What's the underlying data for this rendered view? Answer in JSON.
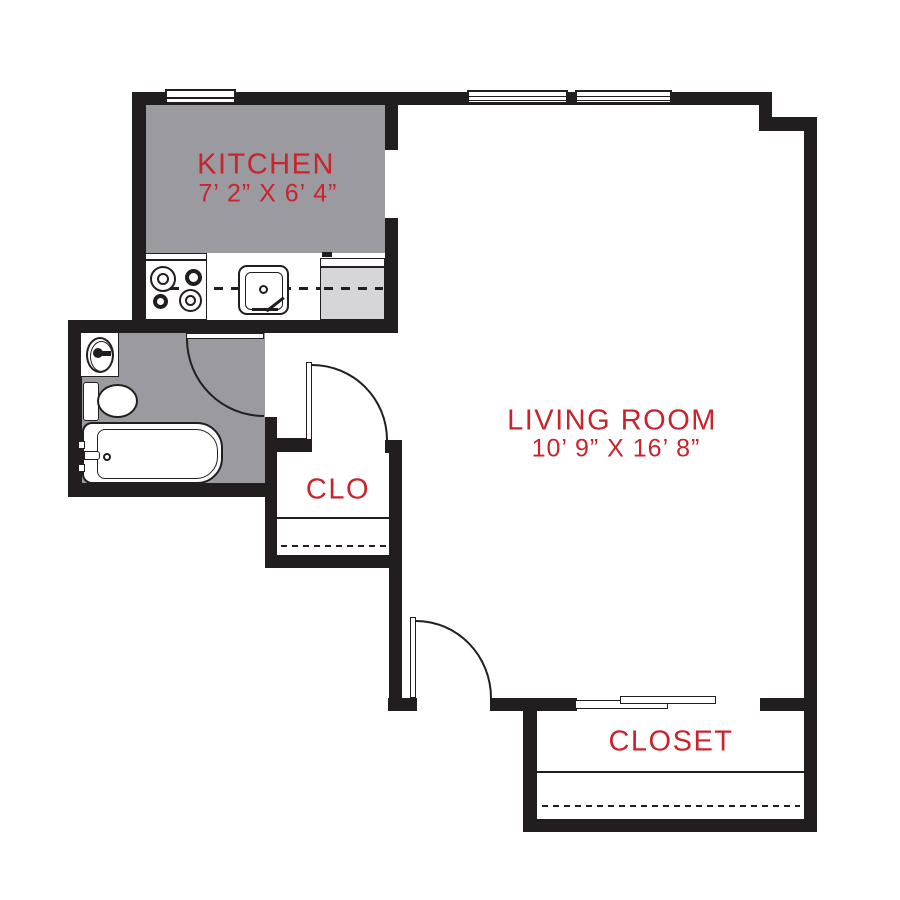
{
  "rooms": {
    "kitchen": {
      "label": "KITCHEN",
      "dims": "7’ 2” X 6’ 4”"
    },
    "living_room": {
      "label": "LIVING ROOM",
      "dims": "10’ 9” X 16’ 8”"
    },
    "clo": {
      "label": "CLO"
    },
    "closet": {
      "label": "CLOSET"
    }
  },
  "colors": {
    "label_red": "#c9232b",
    "wall_black": "#221e1f",
    "room_gray": "#9b9aa0",
    "appliance_gray": "#d6d5d9",
    "background": "#ffffff"
  }
}
